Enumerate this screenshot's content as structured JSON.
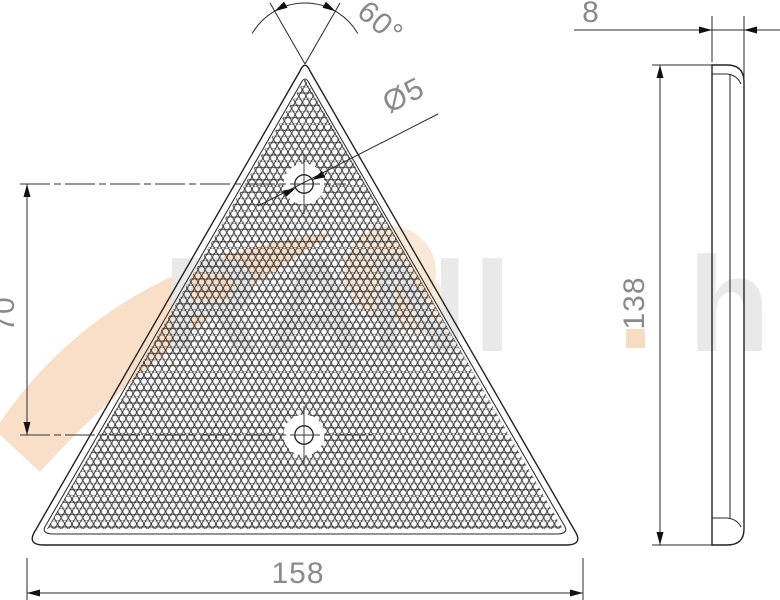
{
  "drawing": {
    "front_view": {
      "apex_angle_label": "60°",
      "hole_diameter_label": "Ø5",
      "hole_spacing_label": "70",
      "base_width_label": "158"
    },
    "side_view": {
      "thickness_label": "8",
      "height_label": "138"
    },
    "watermark": {
      "part1": "RANI",
      "part2": "hu"
    },
    "colors": {
      "line": "#222222",
      "dim_text": "#8a8a8a",
      "watermark_gray": "#e9e9e9",
      "watermark_orange": "#f8dcc2"
    }
  }
}
